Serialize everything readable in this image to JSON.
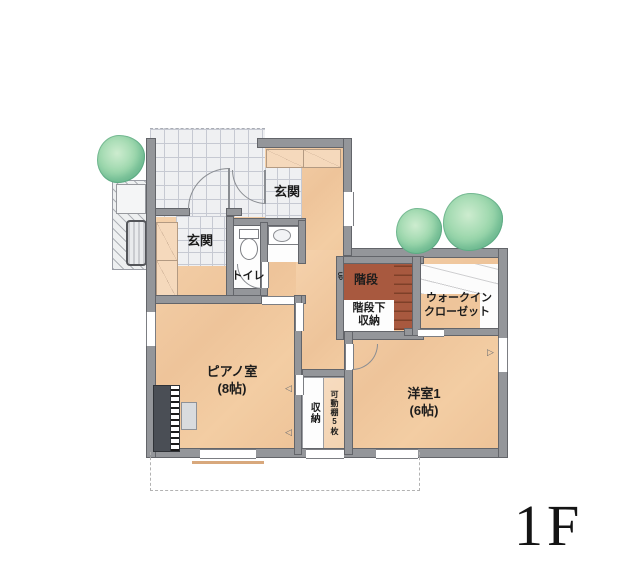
{
  "floor_indicator": "1F",
  "rooms": {
    "genkan_upper": {
      "label": "玄関"
    },
    "genkan_lower": {
      "label": "玄関"
    },
    "toilet": {
      "label": "トイレ"
    },
    "stairs": {
      "label": "階段",
      "up_label": "UP"
    },
    "under_stair_storage": {
      "line1": "階段下",
      "line2": "収納"
    },
    "walk_in_closet": {
      "line1": "ウォークイン",
      "line2": "クローゼット"
    },
    "piano_room": {
      "label": "ピアノ室",
      "size": "(8帖)"
    },
    "western_room_1": {
      "label": "洋室1",
      "size": "(6帖)"
    },
    "storage": {
      "label": "収納",
      "note": "可動棚5枚"
    }
  },
  "colors": {
    "floor": "#f1c9a2",
    "wall": "#94969a",
    "stairs": "#a8593f",
    "tile": "#eff0f2",
    "tree": "#82caa0"
  }
}
